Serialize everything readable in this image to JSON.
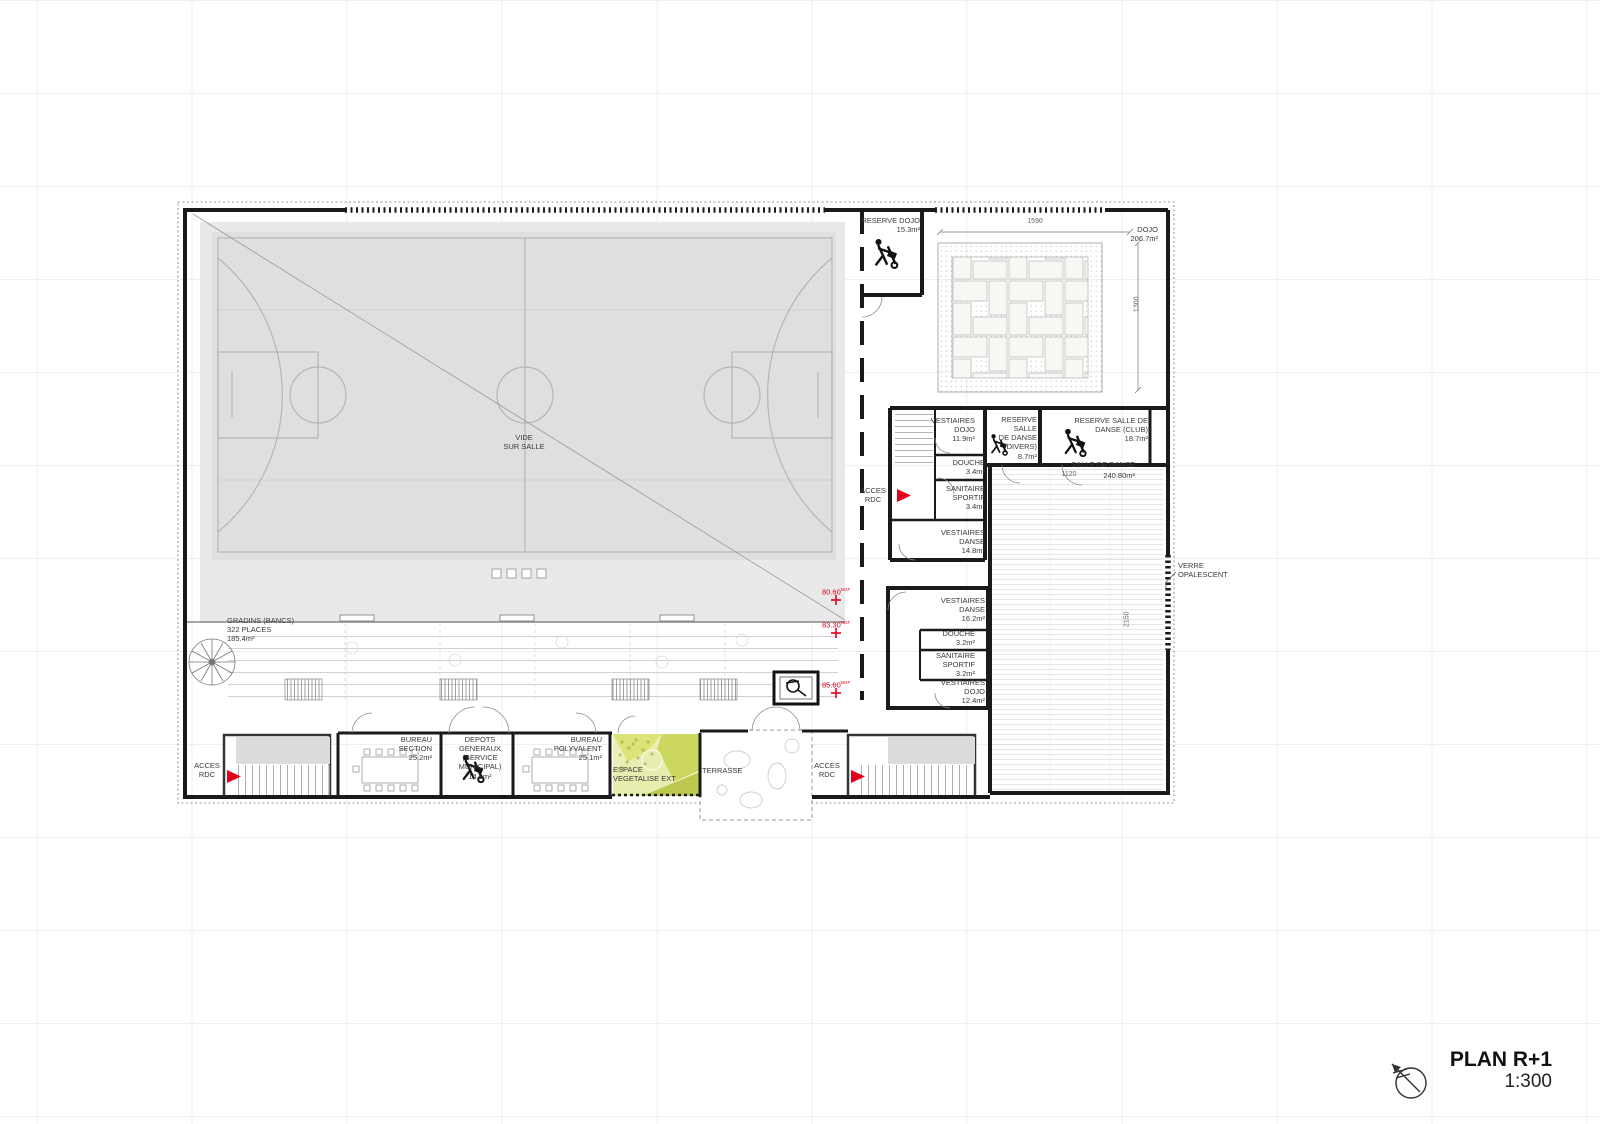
{
  "title_block": {
    "title": "PLAN R+1",
    "scale": "1:300"
  },
  "colors": {
    "wall": "#1a1a1a",
    "red": "#e2001a",
    "label": "#3a3a3a",
    "dim": "#666666",
    "court": "#dfdfdf",
    "hall": "#e9e9e9",
    "courtline": "#b5b5b5",
    "green_light": "#edf0b6",
    "green_mid": "#ccd75f",
    "green_dark": "#8aa63c"
  },
  "labels": [
    {
      "name": "label-reserve-dojo",
      "lines": [
        "RESERVE DOJO",
        "15.3m²"
      ],
      "x": 830,
      "y": 216,
      "w": 90,
      "align": "right"
    },
    {
      "name": "label-dojo",
      "lines": [
        "DOJO",
        "206.7m²"
      ],
      "x": 1078,
      "y": 225,
      "w": 80,
      "align": "right"
    },
    {
      "name": "dim-1590",
      "lines": [
        "1590"
      ],
      "x": 1005,
      "y": 218,
      "w": 60,
      "align": "center",
      "dim": true
    },
    {
      "name": "dim-1300",
      "lines": [
        "1300"
      ],
      "x": 1118,
      "y": 300,
      "w": 40,
      "align": "center",
      "dim": true,
      "rotate": true
    },
    {
      "name": "label-vestiaires-dojo-1",
      "lines": [
        "VESTIAIRES",
        "DOJO",
        "11.9m²"
      ],
      "x": 885,
      "y": 416,
      "w": 90,
      "align": "right"
    },
    {
      "name": "label-reserve-salle-danse-divers",
      "lines": [
        "RESERVE",
        "SALLE",
        "DE DANSE",
        "(DIVERS)",
        "8.7m²"
      ],
      "x": 965,
      "y": 415,
      "w": 72,
      "align": "right"
    },
    {
      "name": "label-reserve-salle-danse-club",
      "lines": [
        "RESERVE SALLE DE",
        "DANSE (CLUB)",
        "18.7m²"
      ],
      "x": 1046,
      "y": 416,
      "w": 102,
      "align": "right"
    },
    {
      "name": "label-douche-1",
      "lines": [
        "DOUCHE",
        "3.4m²"
      ],
      "x": 913,
      "y": 458,
      "w": 72,
      "align": "right"
    },
    {
      "name": "label-sanitaire-sportif-1",
      "lines": [
        "SANITAIRE",
        "SPORTIF",
        "3.4m²"
      ],
      "x": 913,
      "y": 484,
      "w": 72,
      "align": "right"
    },
    {
      "name": "label-salle-de-danse",
      "lines": [
        "SALLE DE DANSE"
      ],
      "x": 1033,
      "y": 460,
      "w": 102,
      "align": "right"
    },
    {
      "name": "label-salle-de-danse-area",
      "lines": [
        "240.80m²"
      ],
      "x": 1093,
      "y": 471,
      "w": 42,
      "align": "right"
    },
    {
      "name": "dim-1120",
      "lines": [
        "1120"
      ],
      "x": 1050,
      "y": 471,
      "w": 38,
      "align": "center",
      "dim": true
    },
    {
      "name": "label-vestiaires-danse-1",
      "lines": [
        "VESTIAIRES",
        "DANSE",
        "14.8m²"
      ],
      "x": 903,
      "y": 528,
      "w": 82,
      "align": "right"
    },
    {
      "name": "label-acces-rdc-mid",
      "lines": [
        "ACCES",
        "RDC"
      ],
      "x": 851,
      "y": 486,
      "w": 44,
      "align": "center"
    },
    {
      "name": "label-vestiaires-danse-2",
      "lines": [
        "VESTIAIRES",
        "DANSE",
        "16.2m²"
      ],
      "x": 903,
      "y": 596,
      "w": 82,
      "align": "right"
    },
    {
      "name": "label-douche-2",
      "lines": [
        "DOUCHE",
        "3.2m²"
      ],
      "x": 908,
      "y": 629,
      "w": 67,
      "align": "right"
    },
    {
      "name": "label-sanitaire-sportif-2",
      "lines": [
        "SANITAIRE",
        "SPORTIF",
        "3.2m²"
      ],
      "x": 903,
      "y": 651,
      "w": 72,
      "align": "right"
    },
    {
      "name": "label-vestiaires-dojo-2",
      "lines": [
        "VESTIAIRES",
        "DOJO",
        "12.4m²"
      ],
      "x": 903,
      "y": 678,
      "w": 82,
      "align": "right"
    },
    {
      "name": "label-verre-opalescent",
      "lines": [
        "VERRE",
        "OPALESCENT"
      ],
      "x": 1178,
      "y": 561,
      "w": 84,
      "align": "left"
    },
    {
      "name": "dim-2150",
      "lines": [
        "2150"
      ],
      "x": 1108,
      "y": 615,
      "w": 40,
      "align": "center",
      "dim": true,
      "rotate": true
    },
    {
      "name": "label-vide-sur-salle",
      "lines": [
        "VIDE",
        "SUR SALLE"
      ],
      "x": 484,
      "y": 433,
      "w": 80,
      "align": "center"
    },
    {
      "name": "level-80-60",
      "lines": [
        "80.60"
      ],
      "sup": "NGF",
      "x": 822,
      "y": 587,
      "w": 44,
      "align": "left",
      "red": true
    },
    {
      "name": "level-83-30",
      "lines": [
        "83.30"
      ],
      "sup": "NGF",
      "x": 822,
      "y": 620,
      "w": 44,
      "align": "left",
      "red": true
    },
    {
      "name": "level-85-60",
      "lines": [
        "85.60"
      ],
      "sup": "NGF",
      "x": 822,
      "y": 680,
      "w": 44,
      "align": "left",
      "red": true
    },
    {
      "name": "label-gradins",
      "lines": [
        "GRADINS (BANCS)",
        "322 PLACES",
        "185.4m²"
      ],
      "x": 227,
      "y": 616,
      "w": 130,
      "align": "left"
    },
    {
      "name": "label-acces-rdc-left",
      "lines": [
        "ACCES",
        "RDC"
      ],
      "x": 186,
      "y": 761,
      "w": 42,
      "align": "center"
    },
    {
      "name": "label-bureau-section",
      "lines": [
        "BUREAU",
        "SECTION",
        "25.2m²"
      ],
      "x": 350,
      "y": 735,
      "w": 82,
      "align": "right"
    },
    {
      "name": "label-depots-generaux",
      "lines": [
        "DEPOTS",
        "GENERAUX",
        "(SERVICE",
        "MUNICIPAL)",
        "14.9m²"
      ],
      "x": 447,
      "y": 735,
      "w": 66,
      "align": "center"
    },
    {
      "name": "label-bureau-polyvalent",
      "lines": [
        "BUREAU",
        "POLYVALENT",
        "25.1m²"
      ],
      "x": 518,
      "y": 735,
      "w": 84,
      "align": "right"
    },
    {
      "name": "label-espace-vegetalise",
      "lines": [
        "ESPACE",
        "VEGETALISE EXT"
      ],
      "x": 613,
      "y": 765,
      "w": 92,
      "align": "left"
    },
    {
      "name": "label-terrasse",
      "lines": [
        "TERRASSE"
      ],
      "x": 702,
      "y": 766,
      "w": 60,
      "align": "left"
    },
    {
      "name": "label-acces-rdc-right",
      "lines": [
        "ACCES",
        "RDC"
      ],
      "x": 806,
      "y": 761,
      "w": 42,
      "align": "center"
    }
  ]
}
